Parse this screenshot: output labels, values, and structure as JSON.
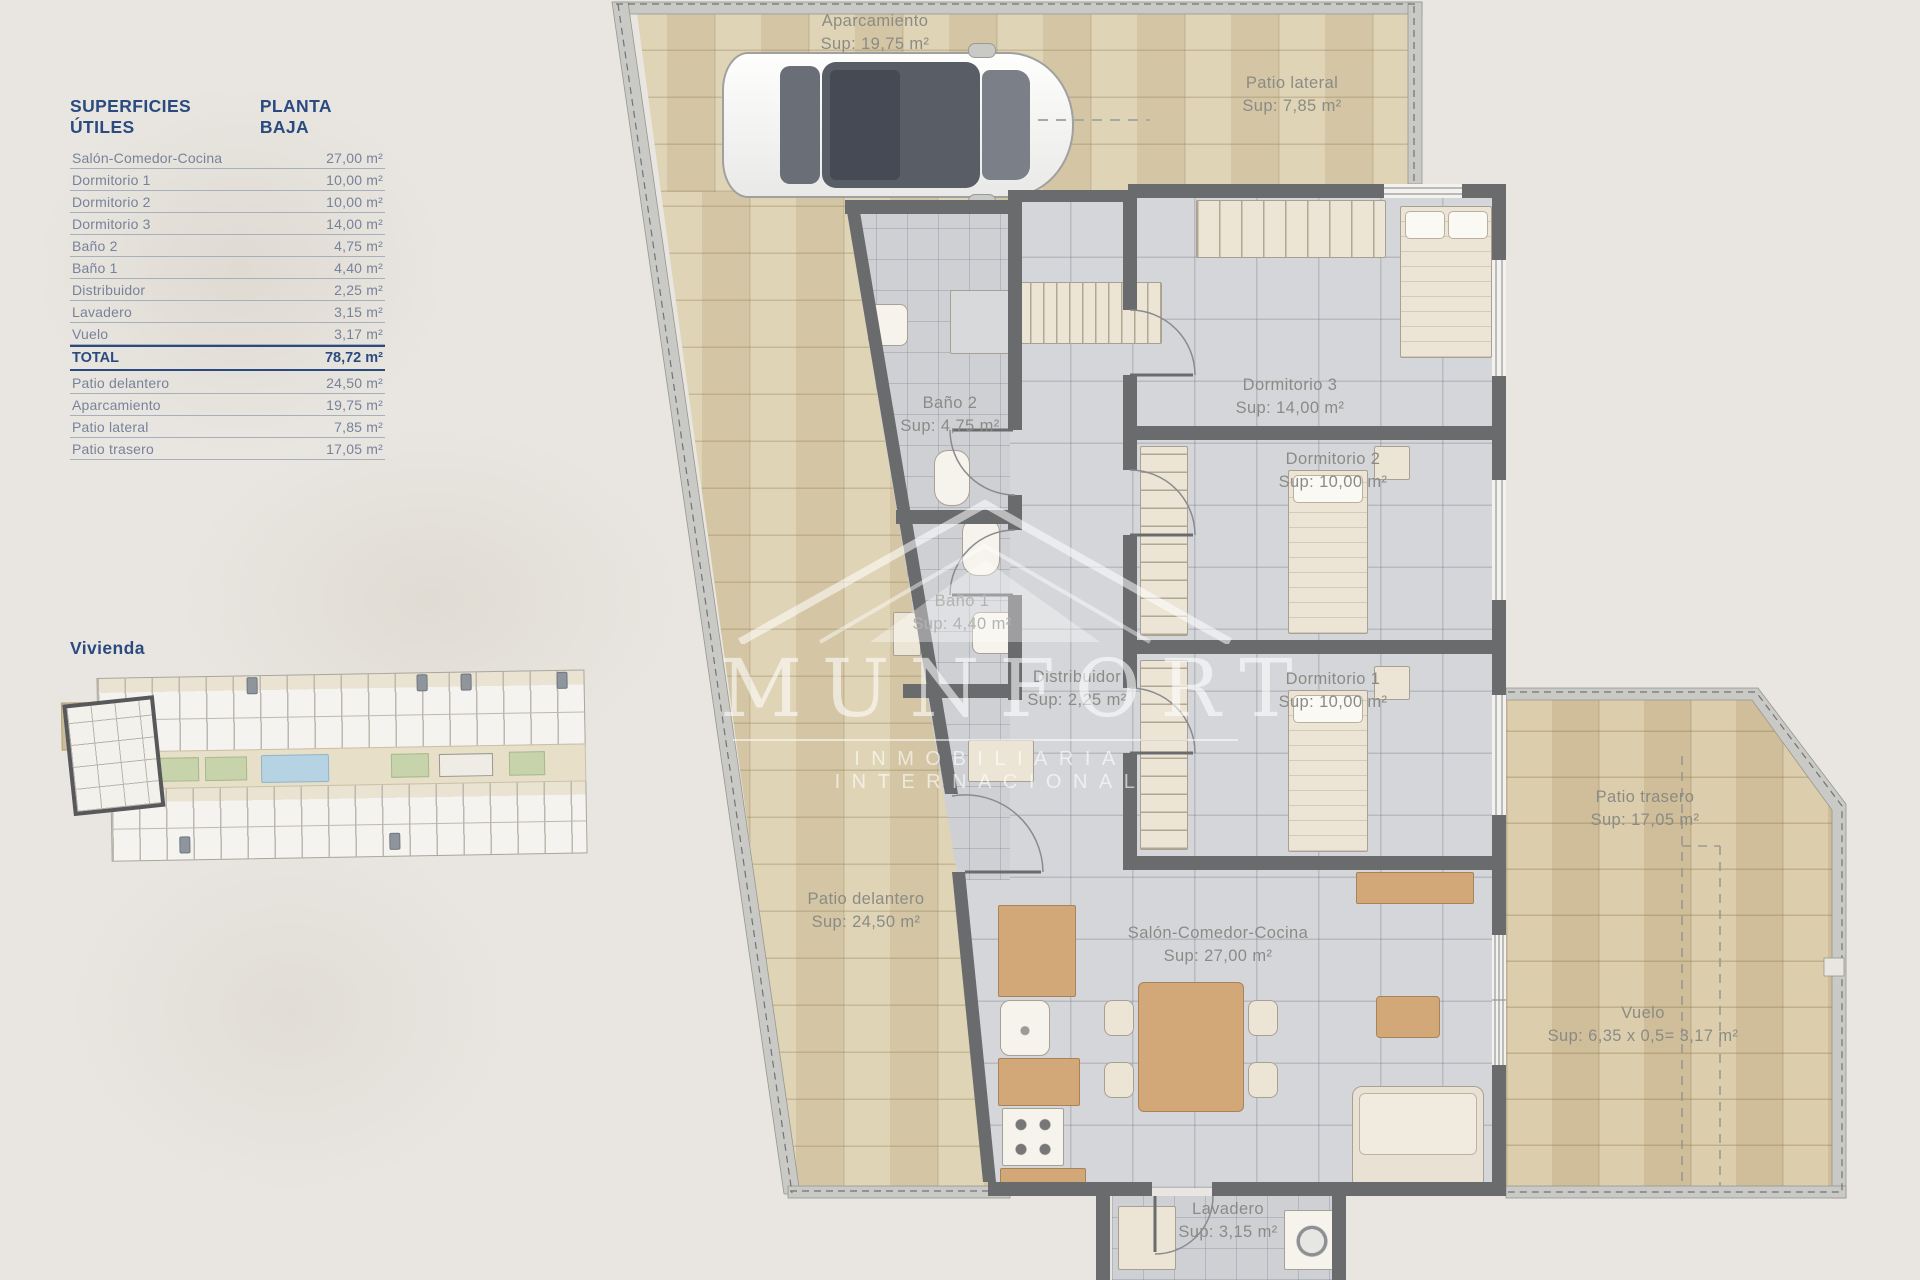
{
  "surfaces_table": {
    "title": "SUPERFICIES ÚTILES",
    "subtitle": "PLANTA BAJA",
    "rows": [
      {
        "label": "Salón-Comedor-Cocina",
        "value": "27,00 m²"
      },
      {
        "label": "Dormitorio 1",
        "value": "10,00 m²"
      },
      {
        "label": "Dormitorio 2",
        "value": "10,00 m²"
      },
      {
        "label": "Dormitorio 3",
        "value": "14,00 m²"
      },
      {
        "label": "Baño 2",
        "value": "4,75 m²"
      },
      {
        "label": "Baño 1",
        "value": "4,40 m²"
      },
      {
        "label": "Distribuidor",
        "value": "2,25 m²"
      },
      {
        "label": "Lavadero",
        "value": "3,15 m²"
      },
      {
        "label": "Vuelo",
        "value": "3,17 m²"
      }
    ],
    "total": {
      "label": "TOTAL",
      "value": "78,72 m²"
    },
    "exterior_rows": [
      {
        "label": "Patio delantero",
        "value": "24,50 m²"
      },
      {
        "label": "Aparcamiento",
        "value": "19,75 m²"
      },
      {
        "label": "Patio lateral",
        "value": "7,85 m²"
      },
      {
        "label": "Patio trasero",
        "value": "17,05 m²"
      }
    ]
  },
  "site_plan": {
    "title": "Vivienda"
  },
  "floor_plan": {
    "labels": {
      "aparcamiento": {
        "name": "Aparcamiento",
        "sup": "Sup: 19,75 m²"
      },
      "patio_lateral": {
        "name": "Patio lateral",
        "sup": "Sup: 7,85 m²"
      },
      "dormitorio3": {
        "name": "Dormitorio 3",
        "sup": "Sup: 14,00 m²"
      },
      "bano2": {
        "name": "Baño 2",
        "sup": "Sup: 4,75 m²"
      },
      "dormitorio2": {
        "name": "Dormitorio 2",
        "sup": "Sup: 10,00 m²"
      },
      "bano1": {
        "name": "Baño 1",
        "sup": "Sup: 4,40 m²"
      },
      "distribuidor": {
        "name": "Distribuidor",
        "sup": "Sup: 2,25 m²"
      },
      "dormitorio1": {
        "name": "Dormitorio 1",
        "sup": "Sup: 10,00 m²"
      },
      "patio_trasero": {
        "name": "Patio trasero",
        "sup": "Sup: 17,05 m²"
      },
      "patio_delantero": {
        "name": "Patio delantero",
        "sup": "Sup: 24,50 m²"
      },
      "salon": {
        "name": "Salón-Comedor-Cocina",
        "sup": "Sup: 27,00 m²"
      },
      "vuelo": {
        "name": "Vuelo",
        "sup": "Sup: 6,35 x 0,5= 3,17 m²"
      },
      "lavadero": {
        "name": "Lavadero",
        "sup": "Sup: 3,15 m²"
      }
    }
  },
  "watermark": {
    "brand": "MUNFORT",
    "tagline": "INMOBILIARIA INTERNACIONAL"
  },
  "colors": {
    "accent_navy": "#2b4a80",
    "table_text": "#77839b",
    "plan_label_gray": "#8b8b86",
    "beige_tile": "#dccfae",
    "gray_tile": "#d4d6d9",
    "wall_dark": "#6a6b6d",
    "boundary_light": "#c9c9c6",
    "pool_blue": "#b6d3e4",
    "garden_green": "#c7d3ab"
  }
}
